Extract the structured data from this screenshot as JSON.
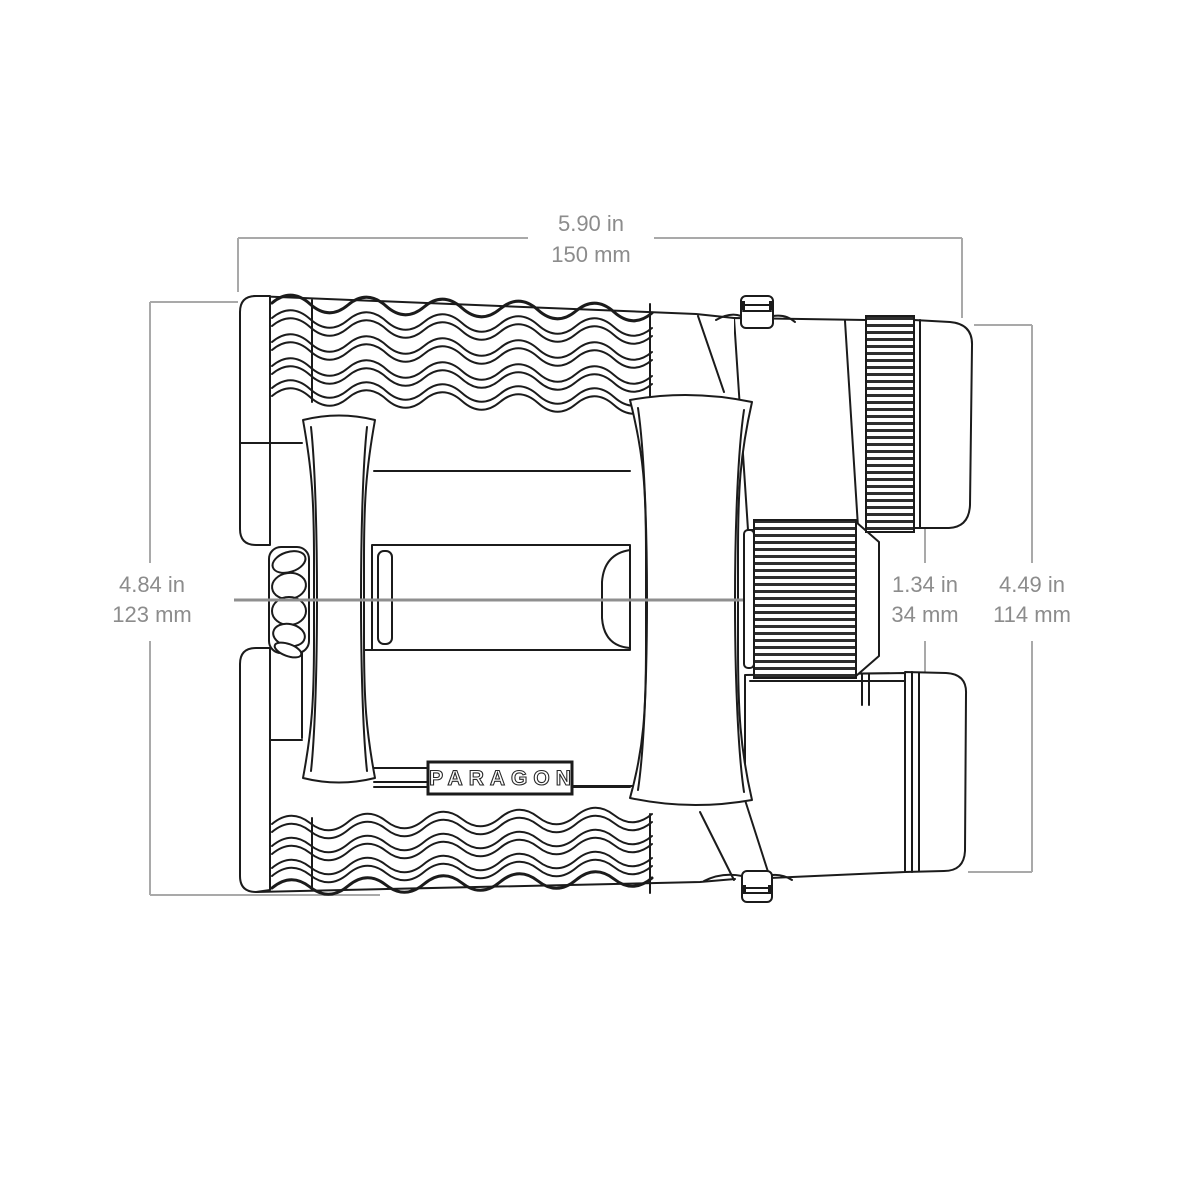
{
  "diagram": {
    "brand_label": "PARAGON",
    "dimensions": {
      "width": {
        "inches": "5.90 in",
        "millimeters": "150 mm"
      },
      "height": {
        "inches": "4.84 in",
        "millimeters": "123 mm"
      },
      "eyepiece_gap": {
        "inches": "1.34 in",
        "millimeters": "34 mm"
      },
      "body_length": {
        "inches": "4.49 in",
        "millimeters": "114 mm"
      }
    },
    "colors": {
      "outline": "#1b1b1b",
      "dimension_line": "#a9a9a9",
      "dimension_text": "#8c8c8c",
      "background": "#ffffff"
    }
  }
}
